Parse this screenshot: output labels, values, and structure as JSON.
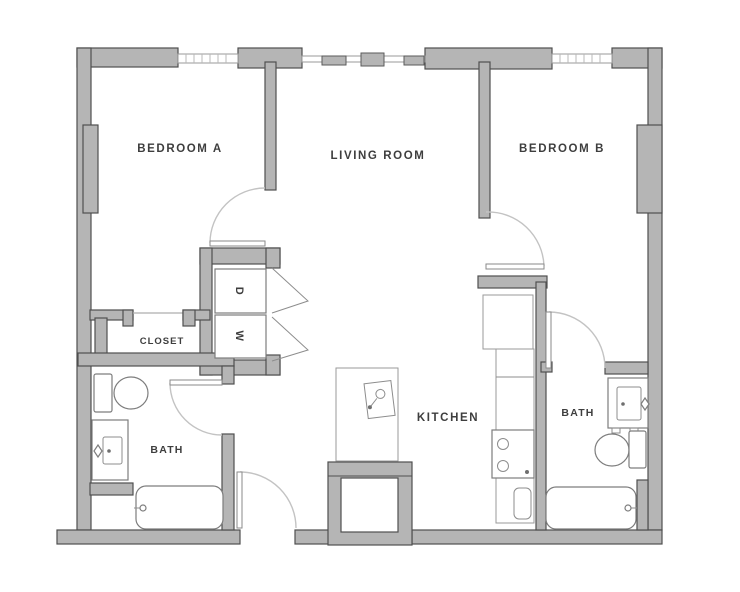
{
  "plan": {
    "type": "two-bedroom-apartment-floor-plan",
    "rooms": {
      "bedroom_a": "BEDROOM A",
      "living_room": "LIVING ROOM",
      "bedroom_b": "BEDROOM B",
      "closet": "CLOSET",
      "bath_a": "BATH",
      "kitchen": "KITCHEN",
      "bath_b": "BATH"
    },
    "appliances": {
      "dryer": "D",
      "washer": "W"
    },
    "colors": {
      "wall_fill": "#b5b5b5",
      "wall_outline": "#4f4f4f",
      "fixture_outline": "#7d7d7d",
      "door_arc": "#c3c3c3",
      "label_text": "#3e3e3e",
      "background": "#ffffff"
    }
  }
}
